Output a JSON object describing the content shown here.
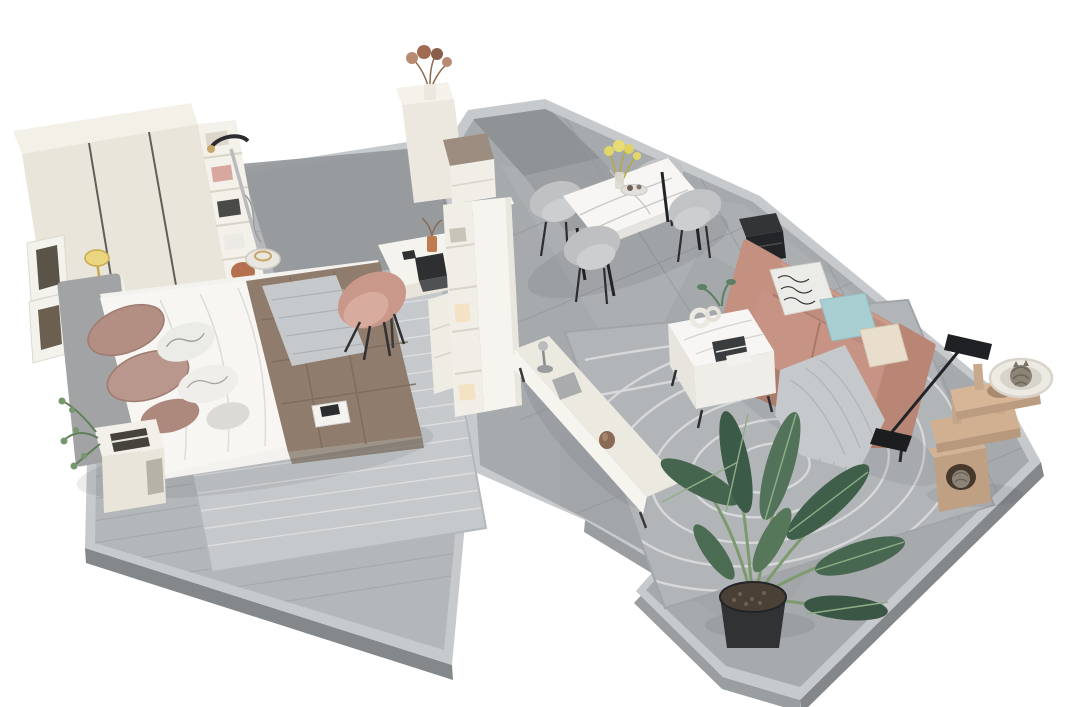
{
  "meta": {
    "scene_type": "isometric-3d-apartment-floorplan-render",
    "rooms": [
      "bedroom",
      "dining-area",
      "living-room"
    ],
    "background": "#ffffff"
  },
  "palette": {
    "background": "#ffffff",
    "bedroom_floor": "#b4b7b9",
    "bedroom_floor_plank": "#a4a7a9",
    "living_floor": "#a6aaad",
    "floor_curb": "#c7cacc",
    "platform_side": "#84888b",
    "dark_tile_patch": "#94989b",
    "bedroom_rug": "#c6c9cb",
    "living_rug": "#b2b5b8",
    "rug_swirl": "#dadcde",
    "cream_furniture": "#ece8df",
    "cream_bright": "#f6f4ee",
    "marble_white": "#f7f6f4",
    "wardrobe_front": "#e9e5db",
    "headboard_gray": "#a2a3a4",
    "bedding_white": "#f3f2ee",
    "comforter_brown": "#8f7c6d",
    "pillow_mauve": "#b28e83",
    "throw_gray": "#c6c9cb",
    "sofa_rose": "#c08e7f",
    "sofa_rose_dark": "#ab7b6c",
    "pillow_teal": "#a9ced1",
    "pillow_cream": "#e9ddcc",
    "pillow_pattern": "#ebebe7",
    "dining_chair_gray": "#c0c1c3",
    "desk_chair_blush": "#c9988b",
    "plant_green_dark": "#3c5a48",
    "plant_green_mid": "#4f6f57",
    "plant_green_light": "#6f9368",
    "plant_pot_black": "#303234",
    "cat_tree_tan": "#cbab8e",
    "cat_fur_gray": "#8d8478",
    "lamp_black": "#202124",
    "steamer_gold": "#c9a566",
    "terracotta": "#c07a50",
    "orange_bin": "#b5714f"
  },
  "objects": {
    "bedroom": [
      "wardrobe-with-shelves",
      "garment-steamer",
      "picture-frames",
      "bedside-table-lamp",
      "double-bed",
      "bedroom-rug",
      "nightstand-with-books",
      "magazine-on-rug",
      "desk-with-laptop",
      "desk-chair",
      "divider-bookshelf",
      "entry-cabinet-with-flowers",
      "entry-bench"
    ],
    "dining": [
      "marble-dining-table",
      "dining-chair-1",
      "dining-chair-2",
      "dining-chair-3",
      "dining-chair-4",
      "flower-vase",
      "serving-plate"
    ],
    "living": [
      "rose-leather-sofa",
      "patterned-pillow",
      "teal-pillow",
      "cream-pillow",
      "knit-throw",
      "black-speaker-cube",
      "floor-lamp",
      "marble-coffee-table",
      "ring-sculpture",
      "magazine",
      "tv-console",
      "silver-figurine",
      "swirl-rug",
      "potted-banana-plant",
      "cat-tree",
      "sleeping-cats"
    ]
  }
}
